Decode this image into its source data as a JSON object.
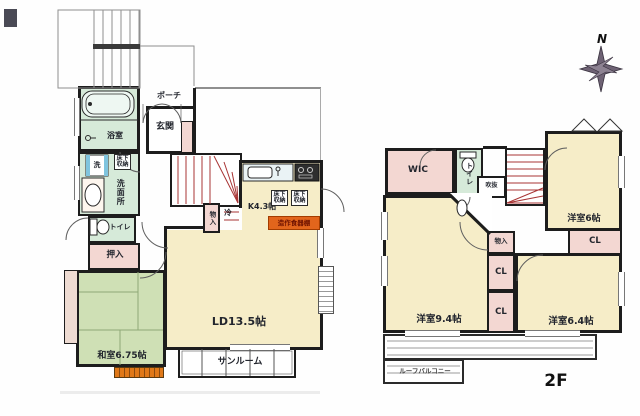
{
  "floor1": {
    "porch": "ポーチ",
    "entrance": "玄関",
    "bathroom": "浴室",
    "washroom": "洗面所",
    "toilet": "トイレ",
    "washer": "洗",
    "underfloor": "床下収納",
    "closet": "押入",
    "tatami_room": "和室6.75帖",
    "living_dining": "LD13.5帖",
    "sunroom": "サンルーム",
    "kitchen": "K4.3帖",
    "storage": "物入",
    "fridge": "冷",
    "cupboard": "造作食器棚"
  },
  "floor2": {
    "wic": "WIC",
    "toilet": "トイレ",
    "void": "吹抜",
    "room_6": "洋室6帖",
    "room_9_4": "洋室9.4帖",
    "room_6_4": "洋室6.4帖",
    "closet": "CL",
    "storage": "物入",
    "balcony": "ルーフバルコニー",
    "floor_label": "2F",
    "compass_north": "N"
  },
  "colors": {
    "room_cream": "#f6edc8",
    "tatami_green": "#cfe0b5",
    "mint": "#d6ead9",
    "pink": "#f3d7d2",
    "wall": "#1d1d1d",
    "stair_red": "#a83434",
    "accent_orange": "#e2651c"
  }
}
